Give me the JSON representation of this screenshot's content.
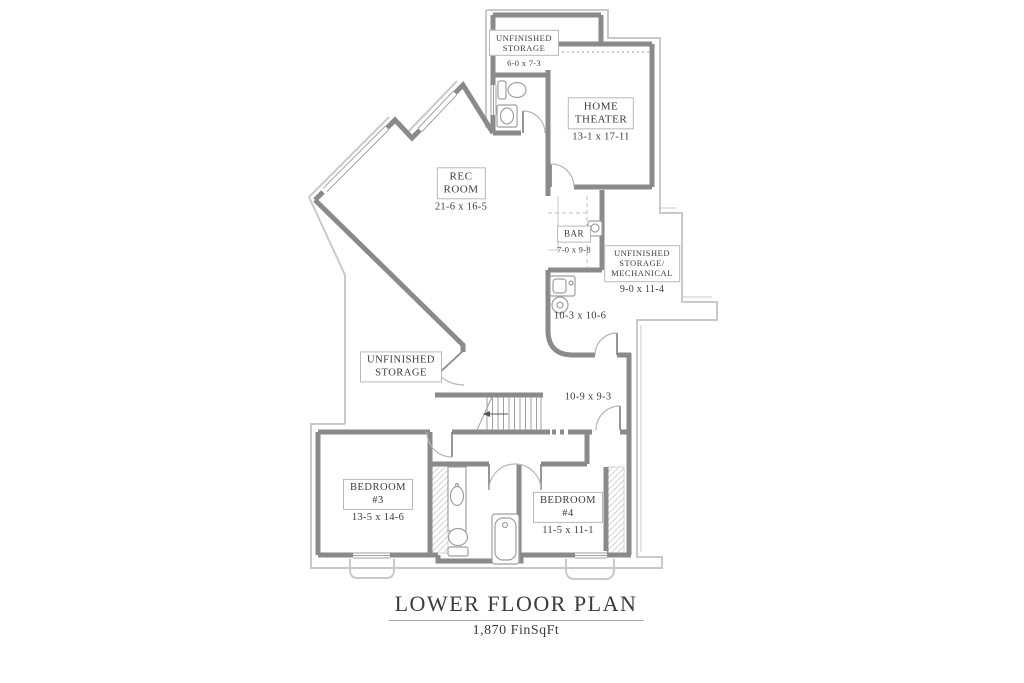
{
  "colors": {
    "wall": "#8a8a8a",
    "thin": "#c9c9c9",
    "fixture": "#9f9f9f",
    "arc": "#b6b6b6",
    "text": "#3c3c3c",
    "box-border": "#b9b9b9",
    "hatch": "#d2d2d2"
  },
  "title": {
    "heading": "LOWER FLOOR PLAN",
    "subheading": "1,870 FinSqFt"
  },
  "rooms": [
    {
      "id": "unfinished-storage-top",
      "name": "UNFINISHED\nSTORAGE",
      "dims": "6-0 x 7-3"
    },
    {
      "id": "home-theater",
      "name": "HOME\nTHEATER",
      "dims": "13-1 x 17-11"
    },
    {
      "id": "rec-room",
      "name": "REC\nROOM",
      "dims": "21-6 x 16-5"
    },
    {
      "id": "bar",
      "name": "BAR",
      "dims": "7-0 x 9-8"
    },
    {
      "id": "unfinished-storage-mechanical",
      "name": "UNFINISHED\nSTORAGE/\nMECHANICAL",
      "dims": "9-0 x 11-4"
    },
    {
      "id": "utility-area",
      "name": "",
      "dims": "10-3 x 10-6"
    },
    {
      "id": "unfinished-storage-left",
      "name": "UNFINISHED\nSTORAGE",
      "dims": ""
    },
    {
      "id": "lower-hall",
      "name": "",
      "dims": "10-9 x 9-3"
    },
    {
      "id": "bedroom-3",
      "name": "BEDROOM\n#3",
      "dims": "13-5 x 14-6"
    },
    {
      "id": "bedroom-4",
      "name": "BEDROOM\n#4",
      "dims": "11-5 x 11-1"
    }
  ]
}
